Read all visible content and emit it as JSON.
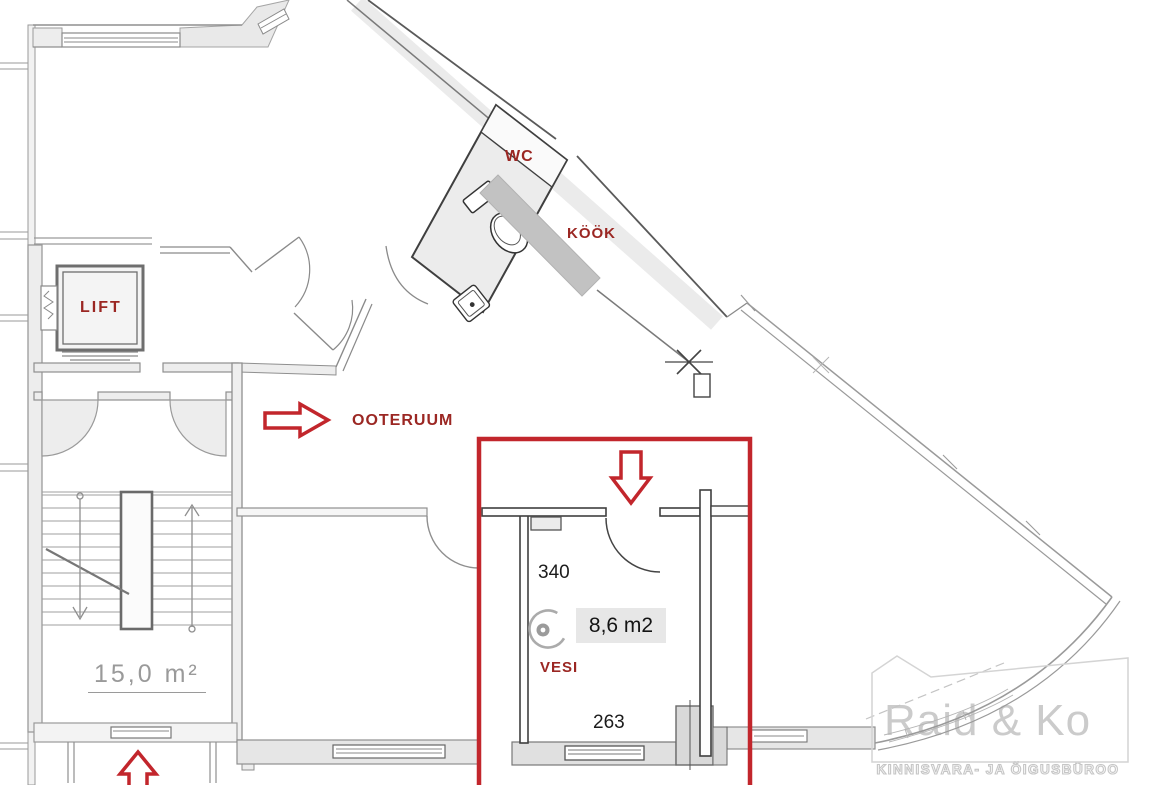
{
  "labels": {
    "wc": "WC",
    "kook": "KÖÖK",
    "lift": "LIFT",
    "ooteruum": "OOTERUUM",
    "vesi": "VESI"
  },
  "areas": {
    "highlighted_room": "8,6 m2",
    "stair_hall": "15,0 m²"
  },
  "dimensions": {
    "room_width": "340",
    "room_depth": "263"
  },
  "watermark": {
    "name": "Raid & Ko",
    "tagline": "KINNISVARA- JA ÕIGUSBÜROO"
  },
  "colors": {
    "annotation_red": "#c2262c",
    "label_red": "#9b2723",
    "dimension_black": "#1c1c1c",
    "wall_gray": "#8f8f8f",
    "wall_dark": "#3f3f3f",
    "fill_light": "#ededed",
    "counter_gray": "#c2c2c2",
    "area_box_bg": "#e7e7e7",
    "watermark_gray": "#cbcbcb",
    "area_hall_gray": "#9a9a9a"
  }
}
